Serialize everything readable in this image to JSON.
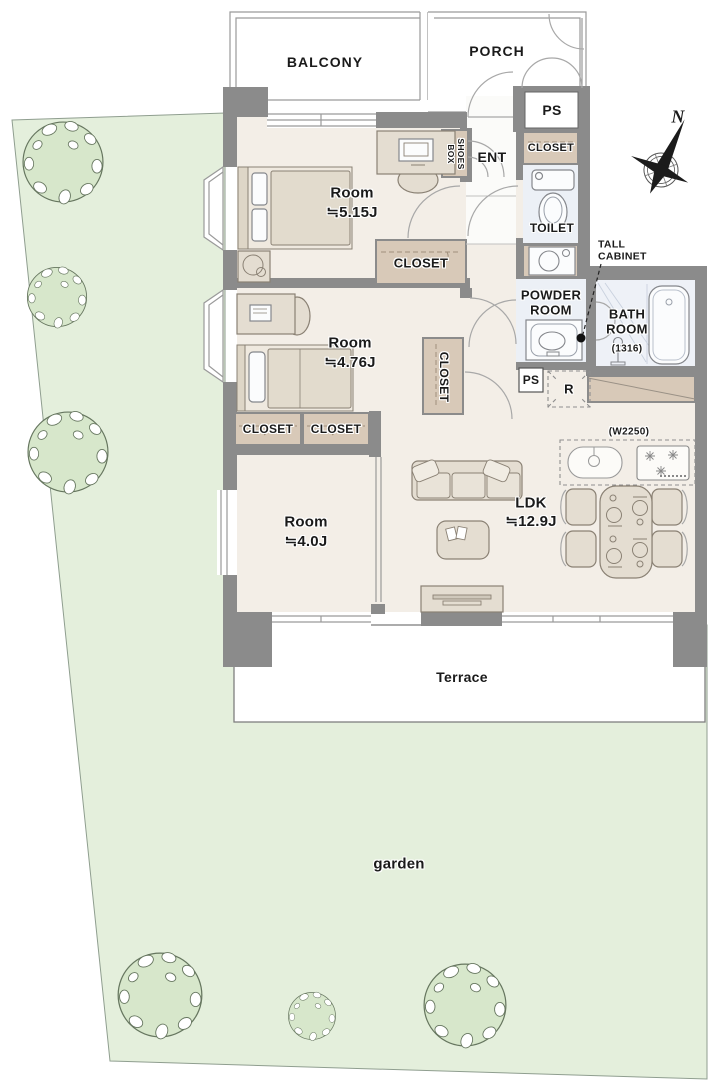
{
  "palette": {
    "wall_gray": "#8b8b8b",
    "floor_beige": "#f3eee7",
    "closet_tan": "#d8c9b8",
    "wet_blue": "#ecf0f6",
    "garden_green": "#e4efdc",
    "tree_green": "#d7e7cb"
  },
  "outdoor": {
    "balcony": "BALCONY",
    "porch": "PORCH",
    "terrace": "Terrace",
    "garden": "garden"
  },
  "entry": {
    "name": "ENT",
    "shoes_box": "SHOES BOX",
    "ps": "PS"
  },
  "rooms": [
    {
      "name": "Room",
      "size": "≒5.15J"
    },
    {
      "name": "Room",
      "size": "≒4.76J"
    },
    {
      "name": "Room",
      "size": "≒4.0J"
    },
    {
      "name": "LDK",
      "size": "≒12.9J"
    }
  ],
  "closets": [
    "CLOSET",
    "CLOSET",
    "CLOSET",
    "CLOSET",
    "CLOSET"
  ],
  "sanitary": {
    "toilet": "TOILET",
    "powder_room": "POWDER ROOM",
    "bath_room": "BATH ROOM",
    "bath_dim": "(1316)",
    "tall_cabinet": "TALL CABINET",
    "ps": "PS",
    "fridge": "R",
    "kitchen_dim": "(W2250)"
  },
  "compass": {
    "north": "N"
  }
}
